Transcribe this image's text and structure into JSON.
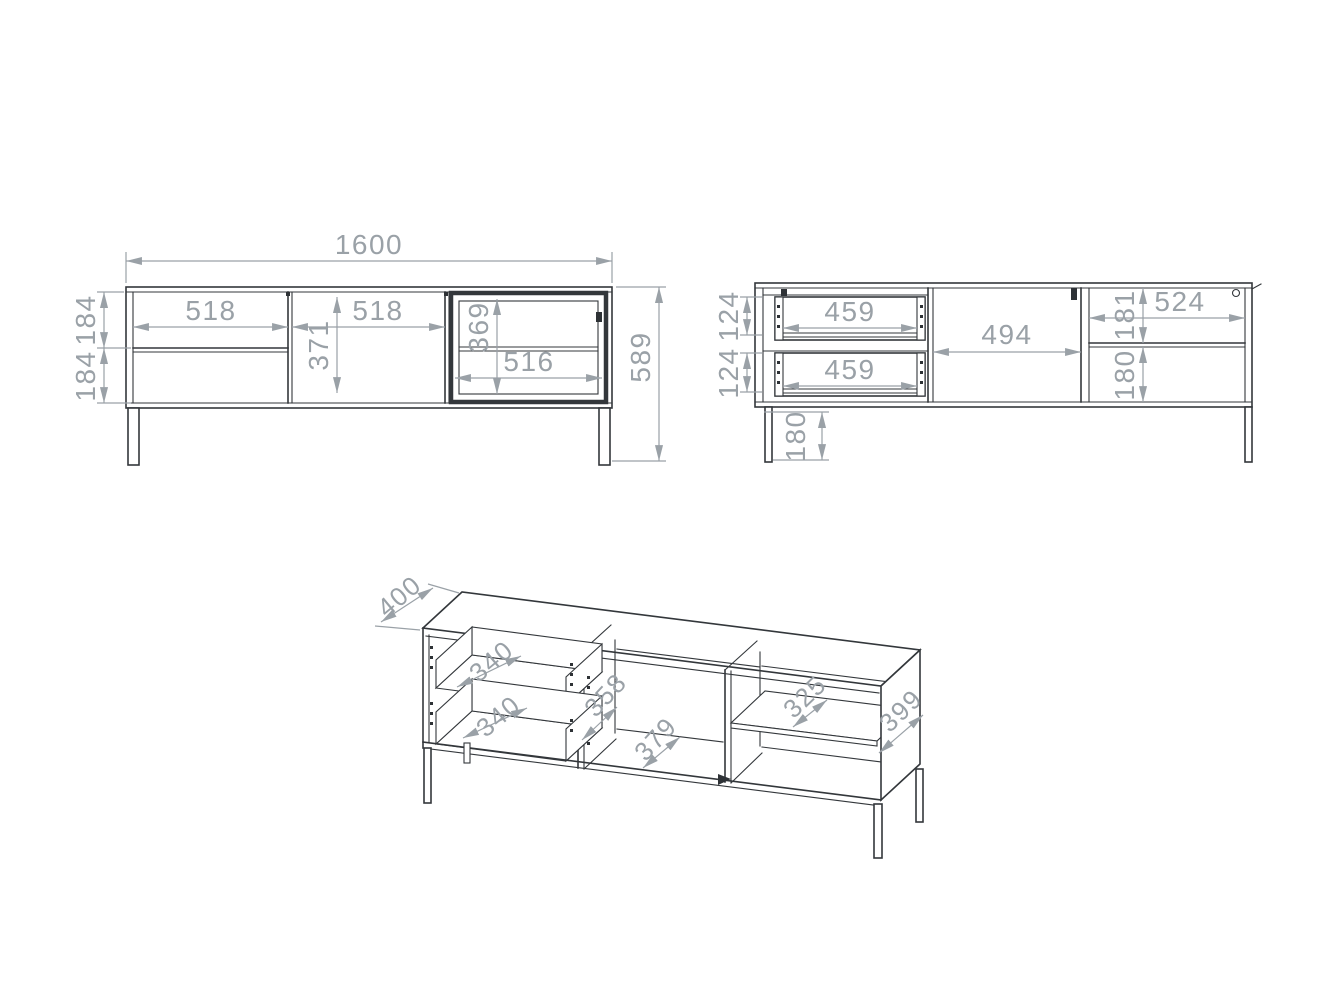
{
  "drawing_type": "furniture-dimension-drawing",
  "colors": {
    "background": "#ffffff",
    "cabinet_line": "#33373b",
    "dimension": "#9aa1a7"
  },
  "front_view": {
    "total_width": "1600",
    "total_height": "589",
    "left_section_width": "518",
    "middle_section_width": "518",
    "middle_section_height": "371",
    "top_drawer_height": "184",
    "bottom_drawer_height": "184",
    "glass_door_height": "369",
    "glass_door_width": "516"
  },
  "internal_view": {
    "top_drawer_width": "459",
    "bottom_drawer_width": "459",
    "top_drawer_height": "124",
    "bottom_drawer_height": "124",
    "middle_width": "494",
    "right_section_width": "524",
    "upper_shelf_height": "181",
    "lower_shelf_height": "180",
    "leg_height": "180"
  },
  "iso_view": {
    "depth": "400",
    "top_drawer_depth": "340",
    "bottom_drawer_depth": "340",
    "divider_depth": "358",
    "middle_floor_depth": "379",
    "shelf_depth": "325",
    "side_panel_depth": "399"
  }
}
